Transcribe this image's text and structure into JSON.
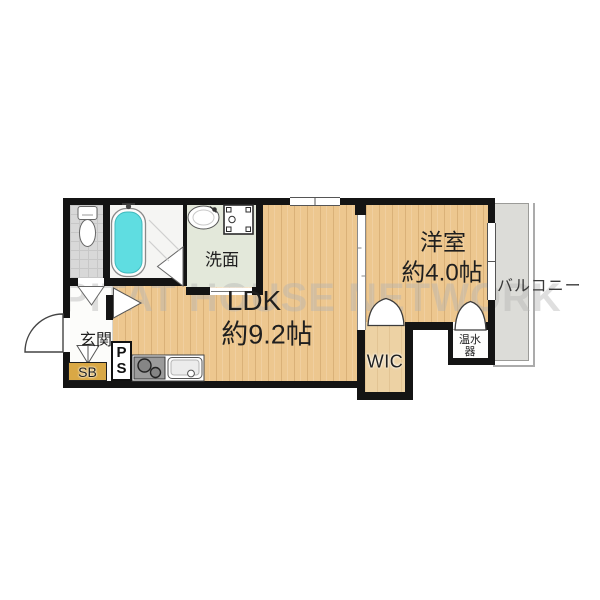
{
  "watermark": "PITAT HOUSE NETWORK",
  "rooms": {
    "ldk": {
      "name": "LDK",
      "size": "約9.2帖"
    },
    "western_room": {
      "name": "洋室",
      "size": "約4.0帖"
    },
    "wic": {
      "name": "WIC"
    },
    "entrance": {
      "name": "玄関"
    },
    "washroom": {
      "name": "洗面"
    },
    "shoe_box": {
      "name": "SB"
    },
    "pipe_space": {
      "line1": "P",
      "line2": "S"
    },
    "water_heater": {
      "line1": "温水",
      "line2": "器"
    },
    "balcony": {
      "name": "バルコニー"
    }
  },
  "fixtures": [
    "toilet",
    "bathtub",
    "wash-basin",
    "washing-machine-pan",
    "gas-stove",
    "kitchen-sink"
  ],
  "colors": {
    "wall": "#141414",
    "wood_floor": "#edc78f",
    "wic_floor": "#edd2a4",
    "balcony_floor": "#dcdcd8",
    "washroom_floor": "#e3e8da",
    "toilet_floor": "#d8d8d8",
    "bath_floor": "#f5f5f3",
    "bathtub_water": "#5fdde1",
    "shoe_box": "#d9a845",
    "watermark": "#b2b2b2"
  }
}
